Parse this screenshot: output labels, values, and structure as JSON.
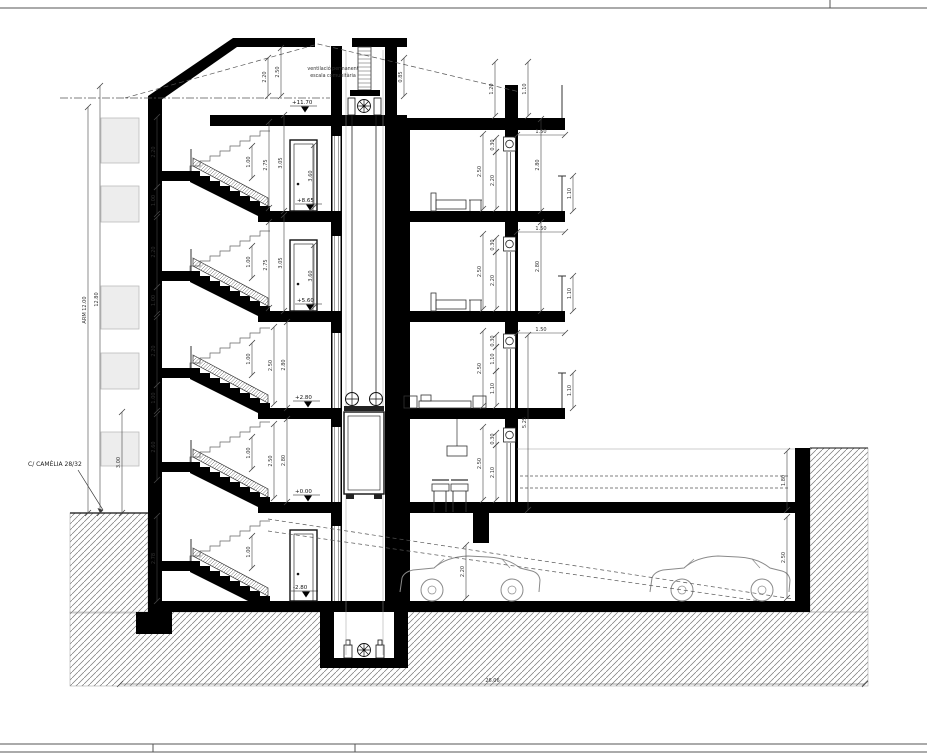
{
  "labels": {
    "street": "C/ CAMÈLIA 28/32",
    "vent_line1": "ventilació permanent",
    "vent_line2": "escala comunitària"
  },
  "levels": [
    {
      "t": "+11.70",
      "x": 292,
      "y": 104
    },
    {
      "t": "+8.65",
      "x": 297,
      "y": 202
    },
    {
      "t": "+5.60",
      "x": 297,
      "y": 302
    },
    {
      "t": "+2.80",
      "x": 295,
      "y": 399
    },
    {
      "t": "+0.00",
      "x": 295,
      "y": 493
    },
    {
      "t": "-2.80",
      "x": 293,
      "y": 589
    }
  ],
  "dims_v": [
    {
      "x": 88,
      "y1": 107,
      "y2": 513,
      "t": "ARM 12.00"
    },
    {
      "x": 100,
      "y1": 86,
      "y2": 513,
      "t": "12.80"
    },
    {
      "x": 122,
      "y1": 412,
      "y2": 513,
      "t": "3.00"
    },
    {
      "x": 157,
      "y1": 117,
      "y2": 187,
      "t": "2.20"
    },
    {
      "x": 157,
      "y1": 187,
      "y2": 214,
      "t": "1.00"
    },
    {
      "x": 157,
      "y1": 217,
      "y2": 287,
      "t": "2.20"
    },
    {
      "x": 157,
      "y1": 287,
      "y2": 314,
      "t": "1.00"
    },
    {
      "x": 157,
      "y1": 317,
      "y2": 385,
      "t": "2.20"
    },
    {
      "x": 157,
      "y1": 385,
      "y2": 411,
      "t": "1.00"
    },
    {
      "x": 157,
      "y1": 414,
      "y2": 480,
      "t": "2.60"
    },
    {
      "x": 157,
      "y1": 516,
      "y2": 601,
      "t": "2.78"
    },
    {
      "x": 252,
      "y1": 146,
      "y2": 178,
      "t": "1.00"
    },
    {
      "x": 252,
      "y1": 246,
      "y2": 278,
      "t": "1.00"
    },
    {
      "x": 252,
      "y1": 343,
      "y2": 375,
      "t": "1.00"
    },
    {
      "x": 252,
      "y1": 437,
      "y2": 469,
      "t": "1.00"
    },
    {
      "x": 252,
      "y1": 536,
      "y2": 568,
      "t": "1.00"
    },
    {
      "x": 269,
      "y1": 122,
      "y2": 208,
      "t": "2.75"
    },
    {
      "x": 269,
      "y1": 222,
      "y2": 308,
      "t": "2.75"
    },
    {
      "x": 284,
      "y1": 115,
      "y2": 211,
      "t": "3.05"
    },
    {
      "x": 284,
      "y1": 215,
      "y2": 311,
      "t": "3.05"
    },
    {
      "x": 274,
      "y1": 327,
      "y2": 404,
      "t": "2.50"
    },
    {
      "x": 274,
      "y1": 424,
      "y2": 498,
      "t": "2.50"
    },
    {
      "x": 287,
      "y1": 322,
      "y2": 408,
      "t": "2.80"
    },
    {
      "x": 287,
      "y1": 419,
      "y2": 502,
      "t": "2.80"
    },
    {
      "x": 314,
      "y1": 145,
      "y2": 207,
      "t": "3.60"
    },
    {
      "x": 314,
      "y1": 245,
      "y2": 307,
      "t": "3.60"
    },
    {
      "x": 268,
      "y1": 58,
      "y2": 96,
      "t": "2.20"
    },
    {
      "x": 281,
      "y1": 48,
      "y2": 96,
      "t": "2.50"
    },
    {
      "x": 404,
      "y1": 58,
      "y2": 96,
      "t": "0.85"
    },
    {
      "x": 495,
      "y1": 62,
      "y2": 116,
      "t": "1.20"
    },
    {
      "x": 528,
      "y1": 62,
      "y2": 116,
      "t": "1.10"
    },
    {
      "x": 483,
      "y1": 134,
      "y2": 209,
      "t": "2.50"
    },
    {
      "x": 496,
      "y1": 152,
      "y2": 209,
      "t": "2.20"
    },
    {
      "x": 496,
      "y1": 138,
      "y2": 152,
      "t": "0.30"
    },
    {
      "x": 541,
      "y1": 119,
      "y2": 211,
      "t": "2.80"
    },
    {
      "x": 573,
      "y1": 176,
      "y2": 211,
      "t": "1.10"
    },
    {
      "x": 483,
      "y1": 234,
      "y2": 309,
      "t": "2.50"
    },
    {
      "x": 496,
      "y1": 252,
      "y2": 309,
      "t": "2.20"
    },
    {
      "x": 496,
      "y1": 238,
      "y2": 252,
      "t": "0.30"
    },
    {
      "x": 541,
      "y1": 222,
      "y2": 311,
      "t": "2.80"
    },
    {
      "x": 573,
      "y1": 276,
      "y2": 311,
      "t": "1.10"
    },
    {
      "x": 483,
      "y1": 331,
      "y2": 406,
      "t": "2.50"
    },
    {
      "x": 496,
      "y1": 347,
      "y2": 371,
      "t": "1.10"
    },
    {
      "x": 496,
      "y1": 371,
      "y2": 406,
      "t": "1.10"
    },
    {
      "x": 496,
      "y1": 335,
      "y2": 347,
      "t": "0.30"
    },
    {
      "x": 573,
      "y1": 373,
      "y2": 408,
      "t": "1.10"
    },
    {
      "x": 483,
      "y1": 427,
      "y2": 500,
      "t": "2.50"
    },
    {
      "x": 496,
      "y1": 445,
      "y2": 500,
      "t": "2.10"
    },
    {
      "x": 496,
      "y1": 433,
      "y2": 445,
      "t": "0.30"
    },
    {
      "x": 528,
      "y1": 335,
      "y2": 510,
      "t": "5.25"
    },
    {
      "x": 787,
      "y1": 451,
      "y2": 510,
      "t": "1.80"
    },
    {
      "x": 787,
      "y1": 517,
      "y2": 598,
      "t": "2.50"
    },
    {
      "x": 466,
      "y1": 545,
      "y2": 598,
      "t": "2.20"
    }
  ],
  "dims_h": [
    {
      "y": 135,
      "x1": 517,
      "x2": 565,
      "t": "1.50"
    },
    {
      "y": 232,
      "x1": 517,
      "x2": 565,
      "t": "1.50"
    },
    {
      "y": 333,
      "x1": 517,
      "x2": 565,
      "t": "1.50"
    },
    {
      "y": 684,
      "x1": 120,
      "x2": 865,
      "t": "26.06"
    }
  ],
  "colors": {
    "wall": "#000000",
    "ink": "#222222",
    "dim_line": "#444444",
    "thin_line": "#888888",
    "hatch": "#777777",
    "window_gray": "#ededed"
  }
}
